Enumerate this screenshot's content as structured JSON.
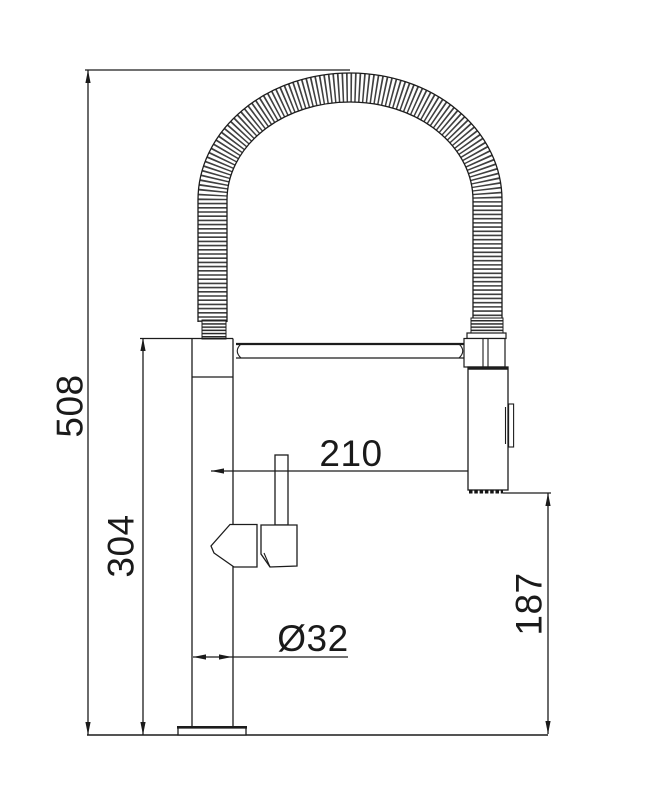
{
  "drawing": {
    "background_color": "#ffffff",
    "line_color": "#1c1c1c",
    "dimensions": {
      "overall_height": "508",
      "body_height": "304",
      "spout_reach": "210",
      "base_diameter": "Ø32",
      "spray_outlet_height": "187"
    }
  }
}
